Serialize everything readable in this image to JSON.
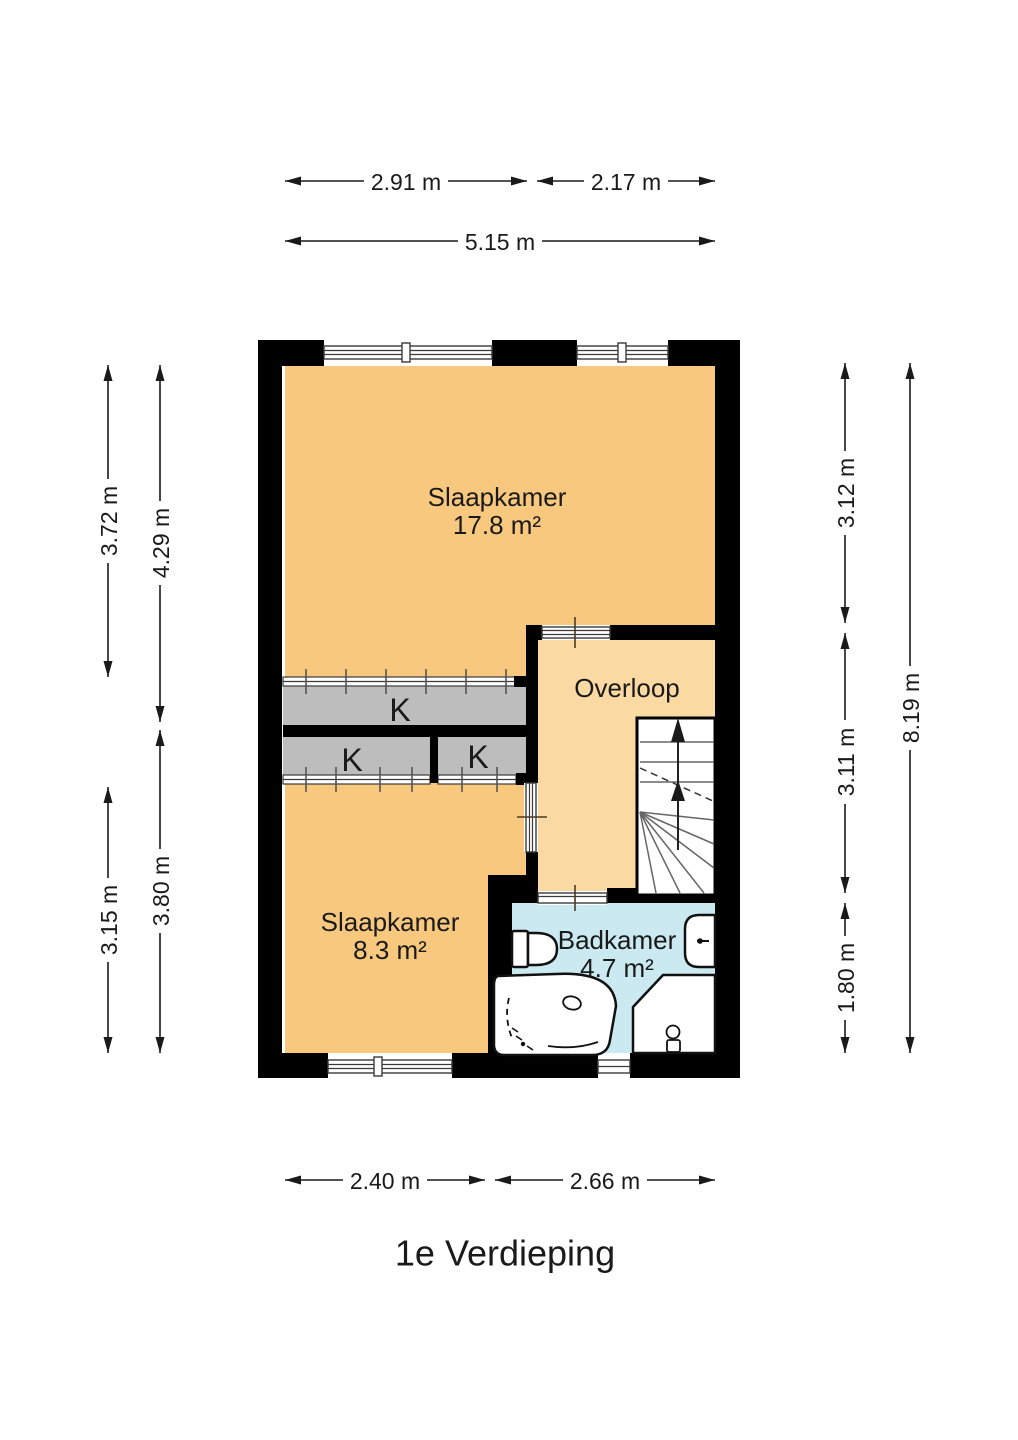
{
  "title": "1e Verdieping",
  "rooms": {
    "slaapkamer1": {
      "name": "Slaapkamer",
      "area": "17.8 m²"
    },
    "overloop": {
      "name": "Overloop"
    },
    "slaapkamer2": {
      "name": "Slaapkamer",
      "area": "8.3 m²"
    },
    "badkamer": {
      "name": "Badkamer",
      "area": "4.7 m²"
    }
  },
  "closets": {
    "k1": "K",
    "k2": "K",
    "k3": "K"
  },
  "dims": {
    "top_row1_left": "2.91 m",
    "top_row1_right": "2.17 m",
    "top_row2": "5.15 m",
    "left_outer_top": "3.72 m",
    "left_inner_top": "4.29 m",
    "left_outer_bottom": "3.15 m",
    "left_inner_bottom": "3.80 m",
    "right_inner_top": "3.12 m",
    "right_inner_mid": "3.11 m",
    "right_inner_bottom": "1.80 m",
    "right_outer": "8.19 m",
    "bottom_left": "2.40 m",
    "bottom_right": "2.66 m"
  },
  "colors": {
    "wall": "#000000",
    "bedroom": "#F8C87E",
    "hall": "#FAD9A2",
    "bath": "#CBE9F0",
    "closet": "#BDBDBD"
  }
}
